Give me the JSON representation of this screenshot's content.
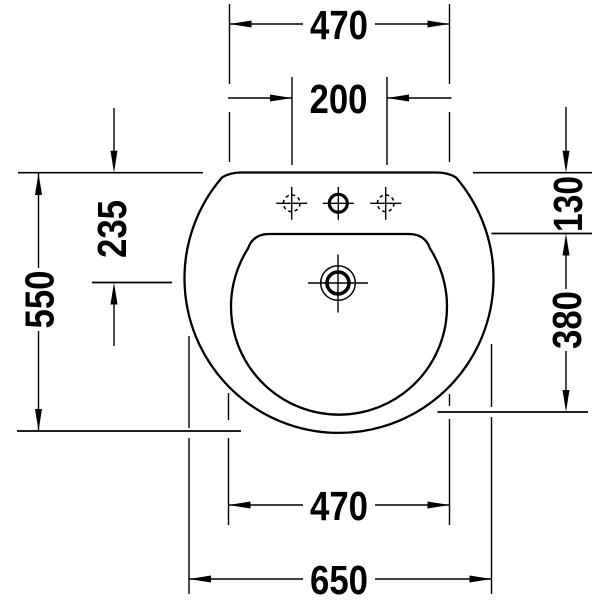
{
  "meta": {
    "background_color": "#ffffff",
    "line_color": "#000000",
    "drawing_type": "technical dimension drawing",
    "subject": "washbasin top (plan) view"
  },
  "drawing": {
    "dimensions": {
      "back_width": "470",
      "tap_hole_spacing": "200",
      "overall_depth": "550",
      "back_to_drain_center": "235",
      "back_to_bowl_edge": "130",
      "bowl_depth": "380",
      "bowl_width": "470",
      "overall_width": "650"
    }
  }
}
